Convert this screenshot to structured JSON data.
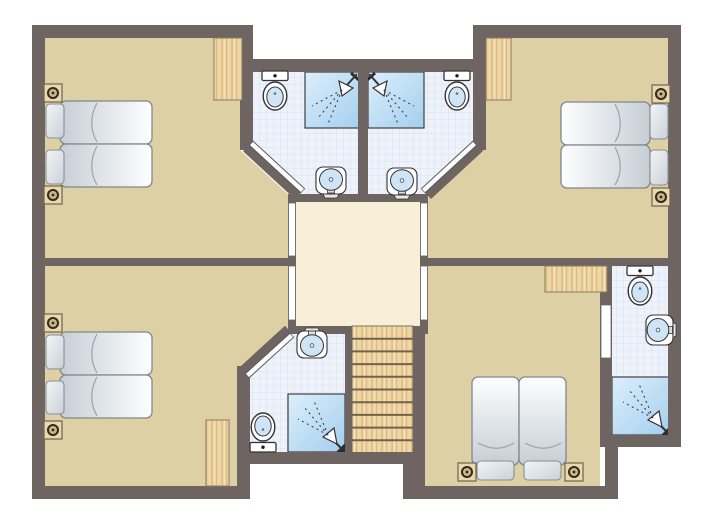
{
  "plan": {
    "kind": "holiday-home-upper-floor-plan",
    "colors": {
      "background": "#ffffff",
      "walls": "#6e6562",
      "bedroom_floor": "#ddd0a5",
      "hall_floor": "#f7efd7",
      "bathroom_tile": "#eef3fb",
      "tile_grid": "#d8e2f2",
      "wood": "#eed7a5",
      "wood_grain": "#dcba83",
      "shower_light": "#ddeefb",
      "shower_dark": "#a3cfee",
      "mattress_light": "#fdfeff",
      "mattress_dark": "#c6ced5",
      "fixture_outline": "#333333",
      "fixture_bowl": "#cfe4f5",
      "door_leaf": "#ffffff",
      "nightstand": "#e9d8ac",
      "tread_line": "#72624e"
    },
    "rooms": [
      {
        "id": "bedroom-top-left",
        "kind": "bedroom",
        "furniture": [
          "double-bed",
          "two-pillows",
          "two-nightstands-with-lamps",
          "wardrobe"
        ]
      },
      {
        "id": "bedroom-top-right",
        "kind": "bedroom",
        "furniture": [
          "double-bed",
          "two-pillows",
          "two-nightstands-with-lamps",
          "wardrobe"
        ]
      },
      {
        "id": "bedroom-bottom-left",
        "kind": "bedroom",
        "furniture": [
          "double-bed",
          "two-pillows",
          "two-nightstands-with-lamps",
          "wardrobe"
        ]
      },
      {
        "id": "bedroom-bottom-right",
        "kind": "bedroom",
        "furniture": [
          "double-bed",
          "two-pillows",
          "two-nightstands-with-lamps",
          "wardrobe"
        ]
      },
      {
        "id": "landing-hall",
        "kind": "hall",
        "furniture": []
      },
      {
        "id": "bathroom-top-left",
        "kind": "bathroom",
        "furniture": [
          "toilet",
          "shower",
          "washbasin"
        ]
      },
      {
        "id": "bathroom-top-right",
        "kind": "bathroom",
        "furniture": [
          "toilet",
          "shower",
          "washbasin"
        ]
      },
      {
        "id": "bathroom-bottom",
        "kind": "bathroom",
        "furniture": [
          "toilet",
          "shower",
          "washbasin"
        ]
      },
      {
        "id": "bathroom-right",
        "kind": "bathroom",
        "furniture": [
          "toilet",
          "shower",
          "washbasin"
        ]
      },
      {
        "id": "staircase",
        "kind": "stairs",
        "furniture": [
          "wooden-steps"
        ]
      }
    ],
    "doors": [
      {
        "id": "door-hall-to-bedroom-top-left"
      },
      {
        "id": "door-hall-to-bedroom-bottom-left"
      },
      {
        "id": "door-hall-to-bedroom-top-right"
      },
      {
        "id": "door-hall-to-bedroom-bottom-right"
      },
      {
        "id": "door-bedroom-top-left-to-bathroom"
      },
      {
        "id": "door-bedroom-top-right-to-bathroom"
      },
      {
        "id": "door-bedroom-bottom-left-to-bathroom"
      },
      {
        "id": "door-bedroom-bottom-right-to-bathroom"
      }
    ],
    "staircase": {
      "treads": 10
    }
  }
}
